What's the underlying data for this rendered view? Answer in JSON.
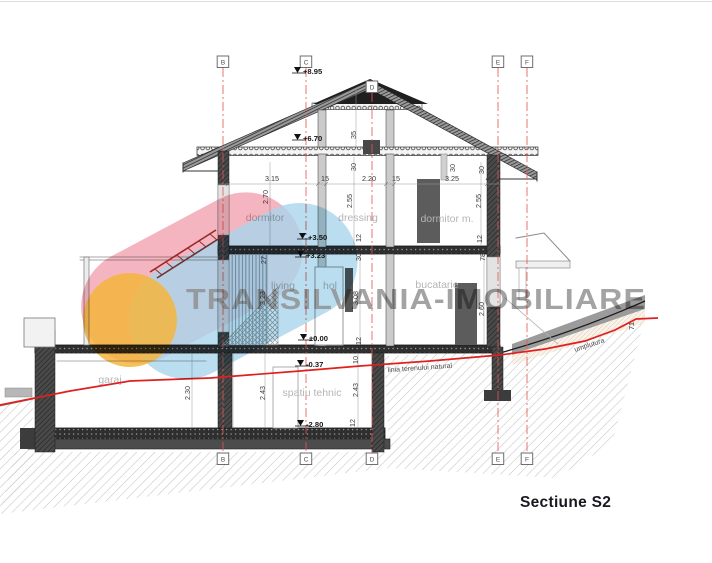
{
  "title": "Sectiune S2",
  "watermark": "TRANSILVANIA-IMOBILIARE",
  "grid": {
    "b": "B",
    "c": "C",
    "d": "D",
    "e": "E",
    "f": "F"
  },
  "rooms": {
    "dormitor": "dormitor",
    "dressing": "dressing",
    "dormitor_m": "dormitor m.",
    "living": "living",
    "hol": "hol",
    "bucatarie": "bucatarie",
    "garaj": "garaj",
    "spatiu_tehnic": "spatiu tehnic"
  },
  "elevations": {
    "ridge": "+8.95",
    "eaves": "+6.70",
    "floor1_top": "+3.50",
    "floor1_fin": "+3.23",
    "ground": "±0.00",
    "terrace": "-0.37",
    "basement": "-2.80"
  },
  "dims": {
    "top": [
      "3.15",
      "15",
      "2.20",
      "15",
      "3.25"
    ],
    "wall": "44",
    "f1": [
      "2.70",
      "2.55",
      "2.55"
    ],
    "attic": [
      "35",
      "30",
      "30",
      "30"
    ],
    "ground": [
      "27",
      "3.23",
      "3.08",
      "2.60",
      "30",
      "12",
      "12",
      "10",
      "78",
      "12"
    ],
    "basement": [
      "2.30",
      "2.25",
      "2.43",
      "2.43",
      "12"
    ],
    "fill_depth": "71"
  },
  "notes": {
    "terrain": "linia terenului natural",
    "fill": "umplutura"
  },
  "colors": {
    "grid_red": "#e4574e",
    "terrain_red": "#e01f1f",
    "logo_pink": "#f2a3b0",
    "logo_blue": "#a9d6ec",
    "logo_yellow": "#f5b63e",
    "watermark_gray": "#8f8f8f",
    "ink": "#2e2e2e"
  }
}
